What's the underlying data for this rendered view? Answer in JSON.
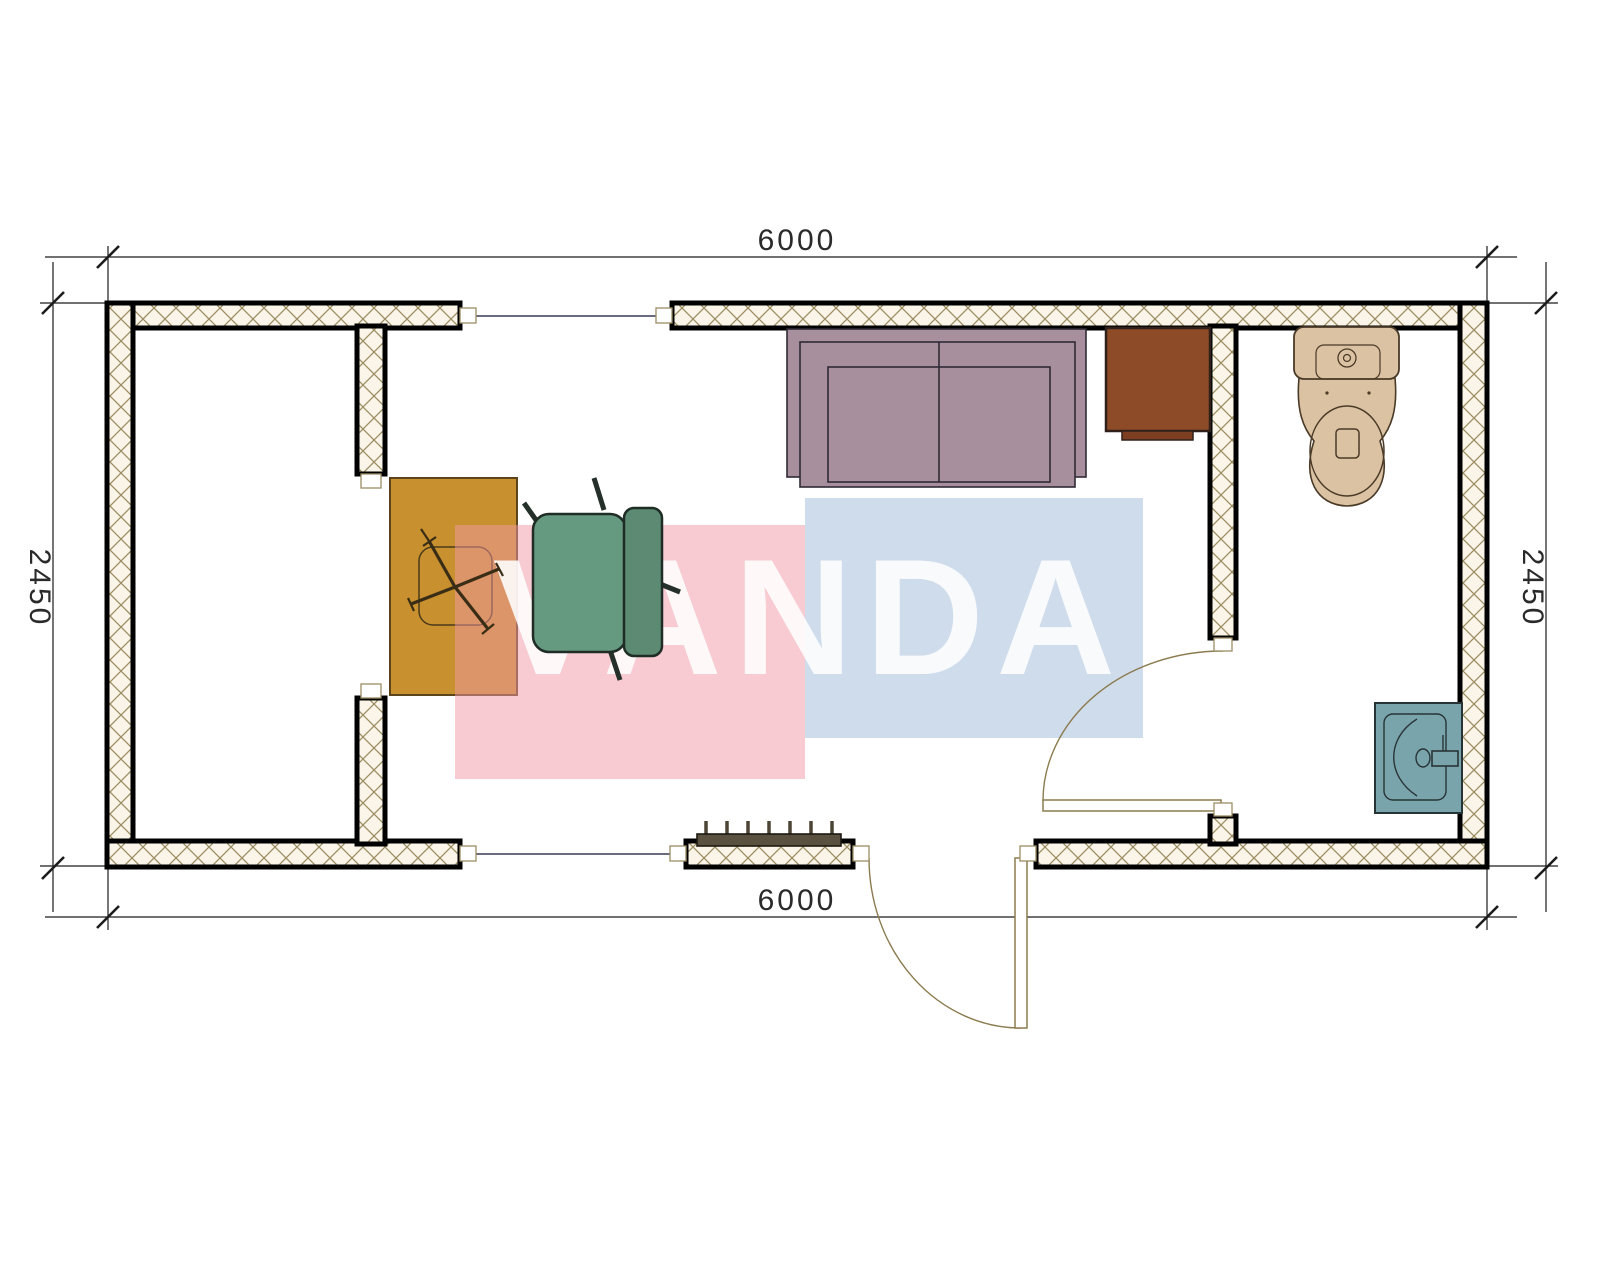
{
  "watermark": {
    "text": "VANDA",
    "pink_color": "#ef98a3",
    "blue_color": "#94b1d4",
    "text_color": "#ffffff"
  },
  "dimensions": {
    "top": "6000",
    "bottom": "6000",
    "left": "2450",
    "right": "2450"
  },
  "plan": {
    "type": "container-office floor plan",
    "wall_fill": "#faf5e8",
    "wall_hatch_line": "#9c8d63",
    "wall_border": "#000000",
    "window_line_color": "#3a3a55",
    "door_line_color": "#8b7b4f",
    "dimension_line_color": "#1c1c1c",
    "furniture": [
      {
        "name": "sofa",
        "color": "#a78f9d"
      },
      {
        "name": "tv-cabinet",
        "color": "#8e4b27"
      },
      {
        "name": "desk",
        "color": "#c8902f"
      },
      {
        "name": "office-chair",
        "color": "#669a80"
      },
      {
        "name": "toilet",
        "color": "#dbc2a2"
      },
      {
        "name": "sink",
        "color": "#7aa4ab"
      },
      {
        "name": "radiator",
        "color": "#5a5140"
      }
    ]
  }
}
